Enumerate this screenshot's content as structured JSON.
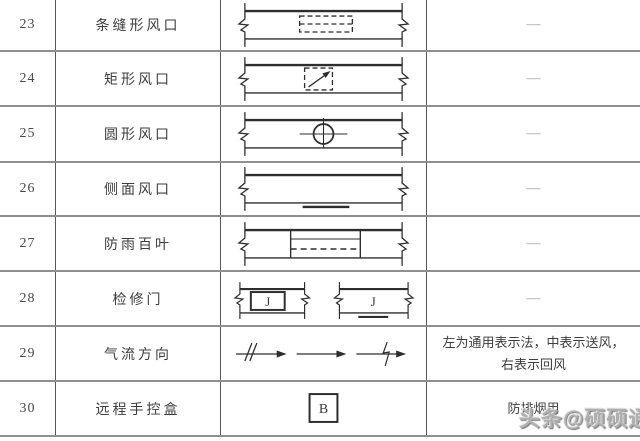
{
  "table": {
    "rows": [
      {
        "num": "23",
        "name": "条缝形风口",
        "symbol": "slot-air-outlet",
        "note": "—"
      },
      {
        "num": "24",
        "name": "矩形风口",
        "symbol": "rectangular-air-outlet",
        "note": "—"
      },
      {
        "num": "25",
        "name": "圆形风口",
        "symbol": "circular-air-outlet",
        "note": "—"
      },
      {
        "num": "26",
        "name": "侧面风口",
        "symbol": "side-air-outlet",
        "note": "—"
      },
      {
        "num": "27",
        "name": "防雨百叶",
        "symbol": "rainproof-louver",
        "note": "—"
      },
      {
        "num": "28",
        "name": "检修门",
        "symbol": "access-door",
        "note": "—",
        "symbol_label": "J"
      },
      {
        "num": "29",
        "name": "气流方向",
        "symbol": "airflow-direction",
        "note": "左为通用表示法，中表示送风，右表示回风"
      },
      {
        "num": "30",
        "name": "远程手控盒",
        "symbol": "remote-hand-control-box",
        "note": "防排烟用",
        "symbol_label": "B"
      }
    ]
  },
  "watermark": {
    "text": "头条@硕硕通",
    "color": "#b0b0b0"
  },
  "colors": {
    "grid_horizontal": "#8f8f8f",
    "grid_vertical": "#575757",
    "symbol_stroke": "#2e2e2e",
    "note_dash": "#9a9a9a",
    "text": "#3d3d3d"
  }
}
